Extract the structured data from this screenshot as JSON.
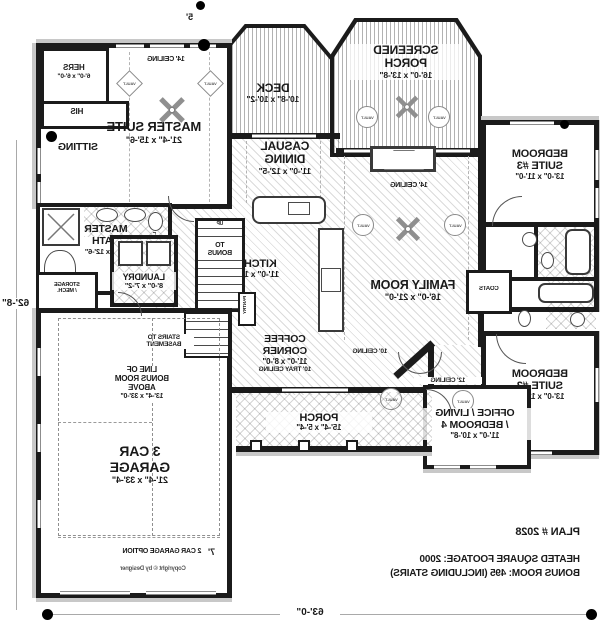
{
  "plan_info": {
    "plan_number": "PLAN # 2028",
    "heated": "HEATED SQUARE FOOTAGE: 2000",
    "bonus": "BONUS ROOM: 495 (INCLUDING STAIRS)",
    "copyright": "Copyright © by Designer"
  },
  "dimensions": {
    "left": "62'-8\"",
    "bottom": "63'-0\"",
    "top_offset": "5'",
    "garage_front_offset": "7'"
  },
  "markers": {
    "vault": "VAULT",
    "up": "UP"
  },
  "rooms": {
    "deck": {
      "name": "DECK",
      "size": "10'-8\" x 10'-2\""
    },
    "screened_porch": {
      "name": "SCREENED",
      "name2": "PORCH",
      "size": "16'-0\" x 13'-8\""
    },
    "master_suite": {
      "name": "MASTER SUITE",
      "size": "21'-4\" x 15'-6\"",
      "ceiling": "14' CEILING"
    },
    "hers": {
      "name": "HERS",
      "size": "6'-0\" x 6'-0\""
    },
    "his": {
      "name": "HIS"
    },
    "sitting": {
      "name": "SITTING"
    },
    "master_bath": {
      "name": "MASTER",
      "name2": "BATH",
      "size": "9'-4\" x 12'-6\""
    },
    "storage": {
      "name": "STORAGE",
      "name2": "/ MECH."
    },
    "laundry": {
      "name": "LAUNDRY",
      "size": "8'-0\" x 7'-2\""
    },
    "bonus_stairs": {
      "line1": "TO",
      "line2": "BONUS"
    },
    "pantry": {
      "name": "PANTRY"
    },
    "linen": {
      "name": "LINEN"
    },
    "casual_dining": {
      "name": "CASUAL",
      "name2": "DINING",
      "size": "11'-0\" x 12'-5\""
    },
    "kitchen": {
      "name": "KITCHEN",
      "size": "11'-0\" x 13'-3\""
    },
    "family_room": {
      "name": "FAMILY ROOM",
      "size": "16'-0\" x 21'-0\"",
      "ceiling": "14' CEILING"
    },
    "bedroom3": {
      "name": "BEDROOM",
      "name2": "SUITE #3",
      "size": "13'-0\" x 11'-0\""
    },
    "bedroom2": {
      "name": "BEDROOM",
      "name2": "SUITE #2",
      "size": "13'-0\" x 11'-0\""
    },
    "office": {
      "name": "OFFICE / LIVING",
      "name2": "/ BEDROOM 4",
      "size": "11'-0\" x 10'-8\"",
      "ceiling": "12' CEILING"
    },
    "coffee_corner": {
      "name": "COFFEE",
      "name2": "CORNER",
      "size": "11'-0\" x 8'-0\"",
      "ceiling": "10' TRAY CEILING"
    },
    "foyer": {
      "ceiling": "10' CEILING"
    },
    "porch": {
      "name": "PORCH",
      "size": "15'-4\" x 5'-4\""
    },
    "garage": {
      "name": "3 CAR",
      "name2": "GARAGE",
      "size": "21'-4\" x 33'-4\""
    },
    "stairs_basement": {
      "line1": "STAIRS TO",
      "line2": "BASEMENT"
    },
    "bonus_outline": {
      "line1": "LINE OF",
      "line2": "BONUS ROOM",
      "line3": "ABOVE",
      "size": "13'-4\" x 33'-0\""
    },
    "garage_option": {
      "name": "2 CAR GARAGE OPTION"
    },
    "coats": {
      "name": "COATS"
    }
  }
}
